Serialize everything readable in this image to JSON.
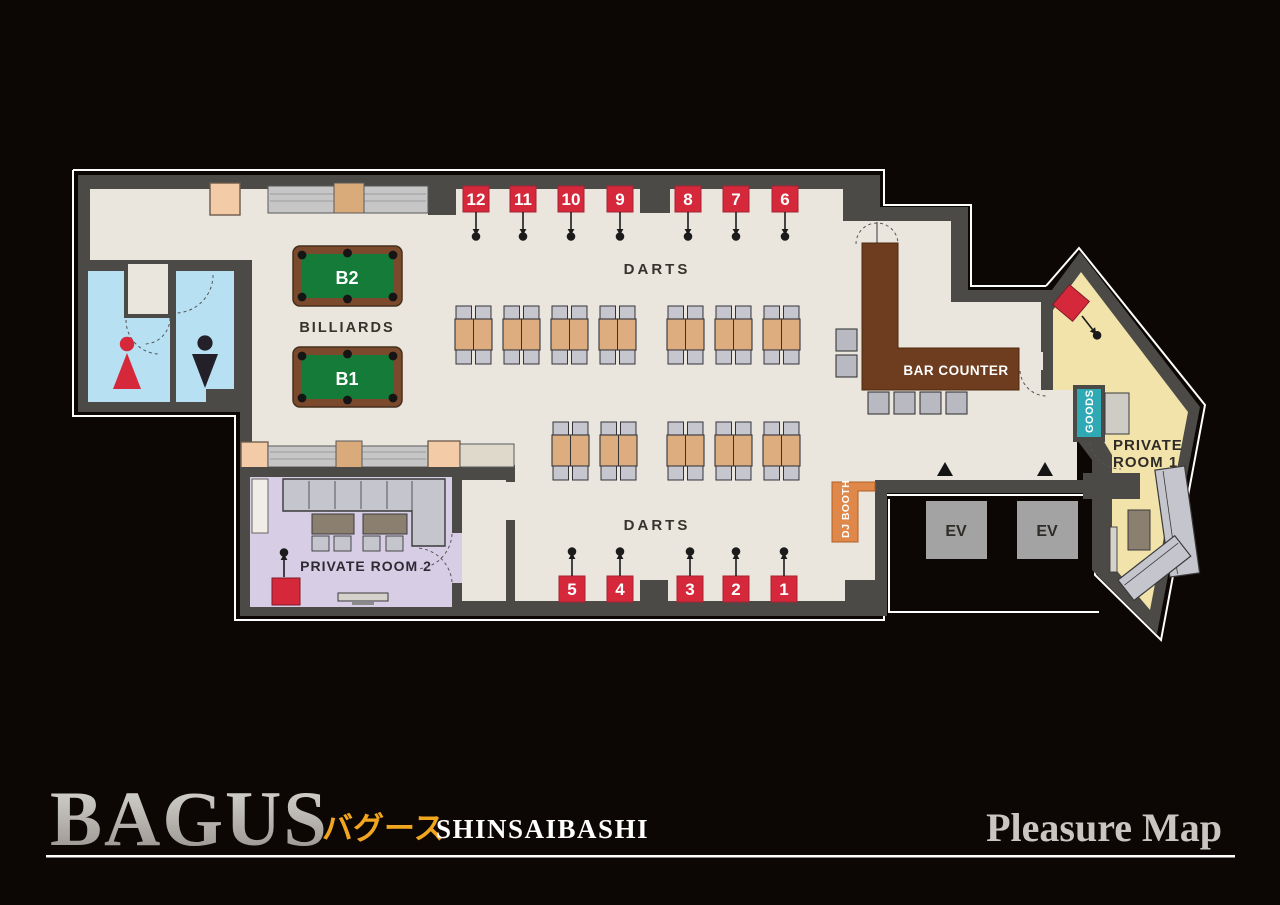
{
  "floor_map": {
    "billiards": {
      "label": "BILLIARDS",
      "tables": [
        "B2",
        "B1"
      ]
    },
    "darts_top": {
      "label": "DARTS",
      "lanes": [
        "12",
        "11",
        "10",
        "9",
        "8",
        "7",
        "6"
      ]
    },
    "darts_bottom": {
      "label": "DARTS",
      "lanes": [
        "5",
        "4",
        "3",
        "2",
        "1"
      ]
    },
    "bar_counter_label": "BAR COUNTER",
    "dj_booth_label": "DJ BOOTH",
    "goods_label": "GOODS",
    "private_room_1": {
      "line1": "PRIVATE",
      "line2": "ROOM 1"
    },
    "private_room_2_label": "PRIVATE ROOM 2",
    "elevators": [
      "EV",
      "EV"
    ]
  },
  "footer": {
    "brand": "BAGUS",
    "brand_kana": "バグース",
    "branch": "SHINSAIBASHI",
    "map_title": "Pleasure Map"
  },
  "icons": {
    "women_restroom": "female-silhouette-icon",
    "men_restroom": "male-silhouette-icon",
    "dart_pin": "dart-icon",
    "elevator_marker": "triangle-up-icon"
  },
  "colors": {
    "background": "#0c0604",
    "floor": "#eae6dd",
    "wall": "#4b4a47",
    "accent_red": "#d5293b",
    "billiard_green": "#147c38",
    "billiard_frame": "#7b4a2d",
    "bar_brown": "#6e3c1e",
    "dj_orange": "#e0874a",
    "goods_teal": "#2fa9b4",
    "room1_yellow": "#f2e3aa",
    "room2_purple": "#d7cde4",
    "restroom_blue": "#b7e0f2",
    "kana_gold": "#f2a51f",
    "logo_silver": "#b5b2ad"
  }
}
